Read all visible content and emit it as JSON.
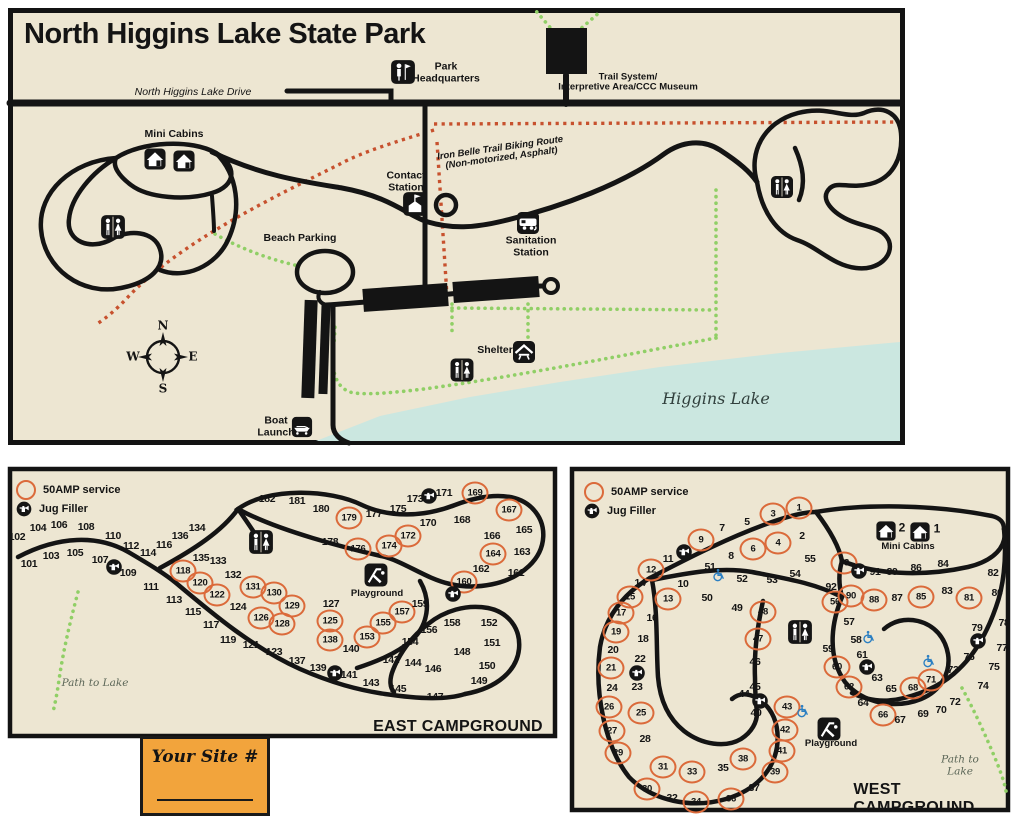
{
  "colors": {
    "background": "#EDE6D2",
    "road": "#141414",
    "water": "#CBE7E0",
    "amp_ring": "#DB6A3A",
    "trail_green": "#90CF66",
    "trail_red": "#C7512E",
    "site_box": "#F2A43C",
    "wheelchair_blue": "#2B7FC2"
  },
  "main": {
    "title": "North Higgins Lake State Park",
    "labels": [
      {
        "t": "North Higgins Lake Drive",
        "x": 193,
        "y": 93,
        "c": "i sm"
      },
      {
        "t": "Park\nHeadquarters",
        "x": 446,
        "y": 73,
        "c": "b sm"
      },
      {
        "t": "Trail System/\nInterpretive Area/CCC Museum",
        "x": 628,
        "y": 83,
        "c": "b xs"
      },
      {
        "t": "Iron Belle Trail Biking Route\n(Non-motorized, Asphalt)",
        "x": 501,
        "y": 154,
        "c": "b i xs",
        "r": -8
      },
      {
        "t": "Mini Cabins",
        "x": 174,
        "y": 135,
        "c": "b sm"
      },
      {
        "t": "Beach Parking",
        "x": 300,
        "y": 239,
        "c": "b sm"
      },
      {
        "t": "Contact\nStation",
        "x": 406,
        "y": 182,
        "c": "b sm"
      },
      {
        "t": "Sanitation\nStation",
        "x": 531,
        "y": 247,
        "c": "b sm"
      },
      {
        "t": "Shelter",
        "x": 495,
        "y": 351,
        "c": "b sm"
      },
      {
        "t": "Boat\nLaunch",
        "x": 276,
        "y": 427,
        "c": "b sm"
      },
      {
        "t": "Higgins Lake",
        "x": 716,
        "y": 399,
        "c": "i lake"
      },
      {
        "t": "N",
        "x": 163,
        "y": 326,
        "c": "cm"
      },
      {
        "t": "S",
        "x": 163,
        "y": 389,
        "c": "cm"
      },
      {
        "t": "W",
        "x": 133,
        "y": 357,
        "c": "cm"
      },
      {
        "t": "E",
        "x": 193,
        "y": 357,
        "c": "cm"
      }
    ],
    "icons": [
      [
        "hq",
        403,
        72,
        26
      ],
      [
        "restroom",
        113,
        227,
        26
      ],
      [
        "cabin",
        155,
        159,
        23
      ],
      [
        "cabin",
        184,
        161,
        23
      ],
      [
        "contact",
        415,
        204,
        26
      ],
      [
        "sanitation",
        528,
        223,
        24
      ],
      [
        "restroom",
        462,
        370,
        25
      ],
      [
        "shelter",
        524,
        352,
        24
      ],
      [
        "restroom",
        782,
        187,
        24
      ],
      [
        "boat",
        302,
        427,
        22
      ]
    ]
  },
  "east": {
    "name": "EAST CAMPGROUND",
    "legend_amp": "50AMP service",
    "legend_jug": "Jug Filler",
    "labels": [
      {
        "t": "Playground",
        "x": 377,
        "y": 594,
        "c": "b xs"
      },
      {
        "t": "Path to Lake",
        "x": 95,
        "y": 684,
        "c": "i path"
      }
    ],
    "icons": [
      [
        "restroom",
        261,
        542,
        26
      ],
      [
        "playground",
        376,
        575,
        25
      ],
      [
        "jug",
        114,
        567,
        17
      ],
      [
        "jug",
        335,
        673,
        17
      ],
      [
        "jug",
        453,
        594,
        17
      ],
      [
        "jug",
        429,
        496,
        17
      ]
    ],
    "sites": [
      [
        101,
        29,
        564,
        0
      ],
      [
        102,
        17,
        537,
        0
      ],
      [
        103,
        51,
        556,
        0
      ],
      [
        104,
        38,
        528,
        0
      ],
      [
        105,
        75,
        553,
        0
      ],
      [
        106,
        59,
        525,
        0
      ],
      [
        107,
        100,
        560,
        0
      ],
      [
        108,
        86,
        527,
        0
      ],
      [
        109,
        128,
        573,
        0
      ],
      [
        110,
        113,
        536,
        0
      ],
      [
        111,
        151,
        587,
        0
      ],
      [
        112,
        131,
        546,
        0
      ],
      [
        113,
        174,
        600,
        0
      ],
      [
        114,
        148,
        553,
        0
      ],
      [
        115,
        193,
        612,
        0
      ],
      [
        116,
        164,
        545,
        0
      ],
      [
        117,
        211,
        625,
        0
      ],
      [
        118,
        183,
        571,
        1
      ],
      [
        119,
        228,
        640,
        0
      ],
      [
        120,
        200,
        583,
        1
      ],
      [
        121,
        251,
        645,
        0
      ],
      [
        122,
        217,
        595,
        1
      ],
      [
        123,
        274,
        652,
        0
      ],
      [
        124,
        238,
        607,
        0
      ],
      [
        125,
        330,
        621,
        1
      ],
      [
        126,
        261,
        618,
        1
      ],
      [
        127,
        331,
        604,
        0
      ],
      [
        128,
        282,
        624,
        1
      ],
      [
        129,
        292,
        606,
        1
      ],
      [
        130,
        274,
        593,
        1
      ],
      [
        131,
        253,
        587,
        1
      ],
      [
        132,
        233,
        575,
        0
      ],
      [
        133,
        218,
        561,
        0
      ],
      [
        134,
        197,
        528,
        0
      ],
      [
        135,
        201,
        558,
        0
      ],
      [
        136,
        180,
        536,
        0
      ],
      [
        137,
        297,
        661,
        0
      ],
      [
        138,
        330,
        640,
        1
      ],
      [
        139,
        318,
        668,
        0
      ],
      [
        140,
        351,
        649,
        0
      ],
      [
        141,
        349,
        675,
        0
      ],
      [
        142,
        391,
        660,
        0
      ],
      [
        143,
        371,
        683,
        0
      ],
      [
        144,
        413,
        663,
        0
      ],
      [
        145,
        398,
        689,
        0
      ],
      [
        146,
        433,
        669,
        0
      ],
      [
        147,
        435,
        697,
        0
      ],
      [
        148,
        462,
        652,
        0
      ],
      [
        149,
        479,
        681,
        0
      ],
      [
        150,
        487,
        666,
        0
      ],
      [
        151,
        492,
        643,
        0
      ],
      [
        152,
        489,
        623,
        0
      ],
      [
        153,
        367,
        637,
        1
      ],
      [
        154,
        410,
        642,
        0
      ],
      [
        155,
        383,
        623,
        1
      ],
      [
        156,
        429,
        630,
        0
      ],
      [
        157,
        402,
        612,
        1
      ],
      [
        158,
        452,
        623,
        0
      ],
      [
        159,
        420,
        604,
        0
      ],
      [
        160,
        464,
        582,
        1
      ],
      [
        161,
        516,
        573,
        0
      ],
      [
        162,
        481,
        569,
        0
      ],
      [
        163,
        522,
        552,
        0
      ],
      [
        164,
        493,
        554,
        1
      ],
      [
        165,
        524,
        530,
        0
      ],
      [
        166,
        492,
        536,
        0
      ],
      [
        167,
        509,
        510,
        1
      ],
      [
        168,
        462,
        520,
        0
      ],
      [
        169,
        475,
        493,
        1
      ],
      [
        170,
        428,
        523,
        0
      ],
      [
        171,
        444,
        493,
        0
      ],
      [
        172,
        408,
        536,
        1
      ],
      [
        173,
        415,
        499,
        0
      ],
      [
        174,
        389,
        546,
        1
      ],
      [
        175,
        398,
        509,
        0
      ],
      [
        176,
        358,
        549,
        1
      ],
      [
        177,
        374,
        514,
        0
      ],
      [
        178,
        330,
        542,
        0
      ],
      [
        179,
        349,
        518,
        1
      ],
      [
        180,
        321,
        509,
        0
      ],
      [
        181,
        297,
        501,
        0
      ],
      [
        182,
        267,
        499,
        0
      ]
    ]
  },
  "west": {
    "name": "WEST CAMPGROUND",
    "legend_amp": "50AMP service",
    "legend_jug": "Jug Filler",
    "labels": [
      {
        "t": "Playground",
        "x": 831,
        "y": 744,
        "c": "b xs"
      },
      {
        "t": "Path to Lake",
        "x": 960,
        "y": 766,
        "c": "i path"
      },
      {
        "t": "Mini Cabins",
        "x": 908,
        "y": 547,
        "c": "b xs"
      },
      {
        "t": "2",
        "x": 902,
        "y": 528,
        "c": "b cab"
      },
      {
        "t": "1",
        "x": 937,
        "y": 529,
        "c": "b cab"
      }
    ],
    "icons": [
      [
        "restroom",
        800,
        632,
        26
      ],
      [
        "playground",
        829,
        729,
        25
      ],
      [
        "cabin",
        886,
        531,
        21
      ],
      [
        "cabin",
        920,
        532,
        21
      ],
      [
        "jug",
        684,
        552,
        17
      ],
      [
        "jug",
        637,
        673,
        17
      ],
      [
        "jug",
        760,
        701,
        17
      ],
      [
        "jug",
        867,
        667,
        17
      ],
      [
        "jug",
        978,
        641,
        17
      ],
      [
        "jug",
        859,
        571,
        17
      ],
      [
        "wheelchair",
        719,
        575,
        15
      ],
      [
        "wheelchair",
        869,
        637,
        15
      ],
      [
        "wheelchair",
        929,
        661,
        15
      ],
      [
        "wheelchair",
        803,
        711,
        15
      ]
    ],
    "sites": [
      [
        1,
        799,
        508,
        1
      ],
      [
        2,
        802,
        536,
        0
      ],
      [
        3,
        773,
        514,
        1
      ],
      [
        4,
        778,
        543,
        1
      ],
      [
        5,
        747,
        522,
        0
      ],
      [
        6,
        753,
        549,
        1
      ],
      [
        7,
        722,
        528,
        0
      ],
      [
        8,
        731,
        556,
        0
      ],
      [
        9,
        701,
        540,
        1
      ],
      [
        10,
        683,
        584,
        0
      ],
      [
        11,
        668,
        559,
        0
      ],
      [
        12,
        651,
        570,
        1
      ],
      [
        13,
        668,
        599,
        1
      ],
      [
        14,
        640,
        583,
        0
      ],
      [
        15,
        630,
        597,
        1
      ],
      [
        16,
        652,
        618,
        0
      ],
      [
        17,
        621,
        613,
        1
      ],
      [
        18,
        643,
        639,
        0
      ],
      [
        19,
        616,
        632,
        1
      ],
      [
        20,
        613,
        650,
        0
      ],
      [
        21,
        611,
        668,
        1
      ],
      [
        22,
        640,
        659,
        0
      ],
      [
        23,
        637,
        687,
        0
      ],
      [
        24,
        612,
        688,
        0
      ],
      [
        25,
        641,
        713,
        1
      ],
      [
        26,
        609,
        707,
        1
      ],
      [
        27,
        612,
        731,
        1
      ],
      [
        28,
        645,
        739,
        0
      ],
      [
        29,
        618,
        753,
        1
      ],
      [
        30,
        647,
        789,
        1
      ],
      [
        31,
        663,
        767,
        1
      ],
      [
        32,
        672,
        798,
        0
      ],
      [
        33,
        692,
        772,
        1
      ],
      [
        34,
        696,
        802,
        1
      ],
      [
        35,
        723,
        768,
        0
      ],
      [
        36,
        731,
        799,
        1
      ],
      [
        37,
        754,
        788,
        0
      ],
      [
        38,
        743,
        759,
        1
      ],
      [
        39,
        775,
        772,
        1
      ],
      [
        40,
        756,
        713,
        0
      ],
      [
        41,
        782,
        751,
        1
      ],
      [
        42,
        785,
        730,
        1
      ],
      [
        43,
        787,
        707,
        1
      ],
      [
        44,
        744,
        694,
        0
      ],
      [
        45,
        755,
        687,
        0
      ],
      [
        46,
        755,
        662,
        0
      ],
      [
        47,
        758,
        639,
        1
      ],
      [
        48,
        763,
        612,
        1
      ],
      [
        49,
        737,
        608,
        0
      ],
      [
        50,
        707,
        598,
        0
      ],
      [
        51,
        710,
        567,
        0
      ],
      [
        52,
        742,
        579,
        0
      ],
      [
        53,
        772,
        580,
        0
      ],
      [
        54,
        795,
        574,
        0
      ],
      [
        55,
        810,
        559,
        0
      ],
      [
        56,
        835,
        602,
        1
      ],
      [
        57,
        849,
        622,
        0
      ],
      [
        58,
        856,
        640,
        0
      ],
      [
        59,
        828,
        649,
        0
      ],
      [
        60,
        837,
        667,
        1
      ],
      [
        61,
        862,
        655,
        0
      ],
      [
        62,
        849,
        687,
        1
      ],
      [
        63,
        877,
        678,
        0
      ],
      [
        64,
        863,
        703,
        0
      ],
      [
        65,
        891,
        689,
        0
      ],
      [
        66,
        883,
        715,
        1
      ],
      [
        67,
        900,
        720,
        0
      ],
      [
        68,
        913,
        688,
        1
      ],
      [
        69,
        923,
        714,
        0
      ],
      [
        70,
        941,
        710,
        0
      ],
      [
        71,
        931,
        680,
        1
      ],
      [
        72,
        955,
        702,
        0
      ],
      [
        73,
        953,
        670,
        0
      ],
      [
        74,
        983,
        686,
        0
      ],
      [
        75,
        994,
        667,
        0
      ],
      [
        76,
        969,
        657,
        0
      ],
      [
        77,
        1002,
        648,
        0
      ],
      [
        78,
        1004,
        623,
        0
      ],
      [
        79,
        977,
        628,
        0
      ],
      [
        80,
        997,
        593,
        0
      ],
      [
        81,
        969,
        598,
        1
      ],
      [
        82,
        993,
        573,
        0
      ],
      [
        83,
        947,
        591,
        0
      ],
      [
        84,
        943,
        564,
        0
      ],
      [
        85,
        921,
        597,
        1
      ],
      [
        86,
        916,
        568,
        0
      ],
      [
        87,
        897,
        598,
        0
      ],
      [
        88,
        874,
        600,
        1
      ],
      [
        89,
        892,
        572,
        0
      ],
      [
        90,
        851,
        596,
        1
      ],
      [
        91,
        875,
        572,
        0
      ],
      [
        92,
        831,
        587,
        0
      ],
      [
        93,
        844,
        563,
        1
      ]
    ]
  },
  "site_box": {
    "label": "Your Site #"
  }
}
